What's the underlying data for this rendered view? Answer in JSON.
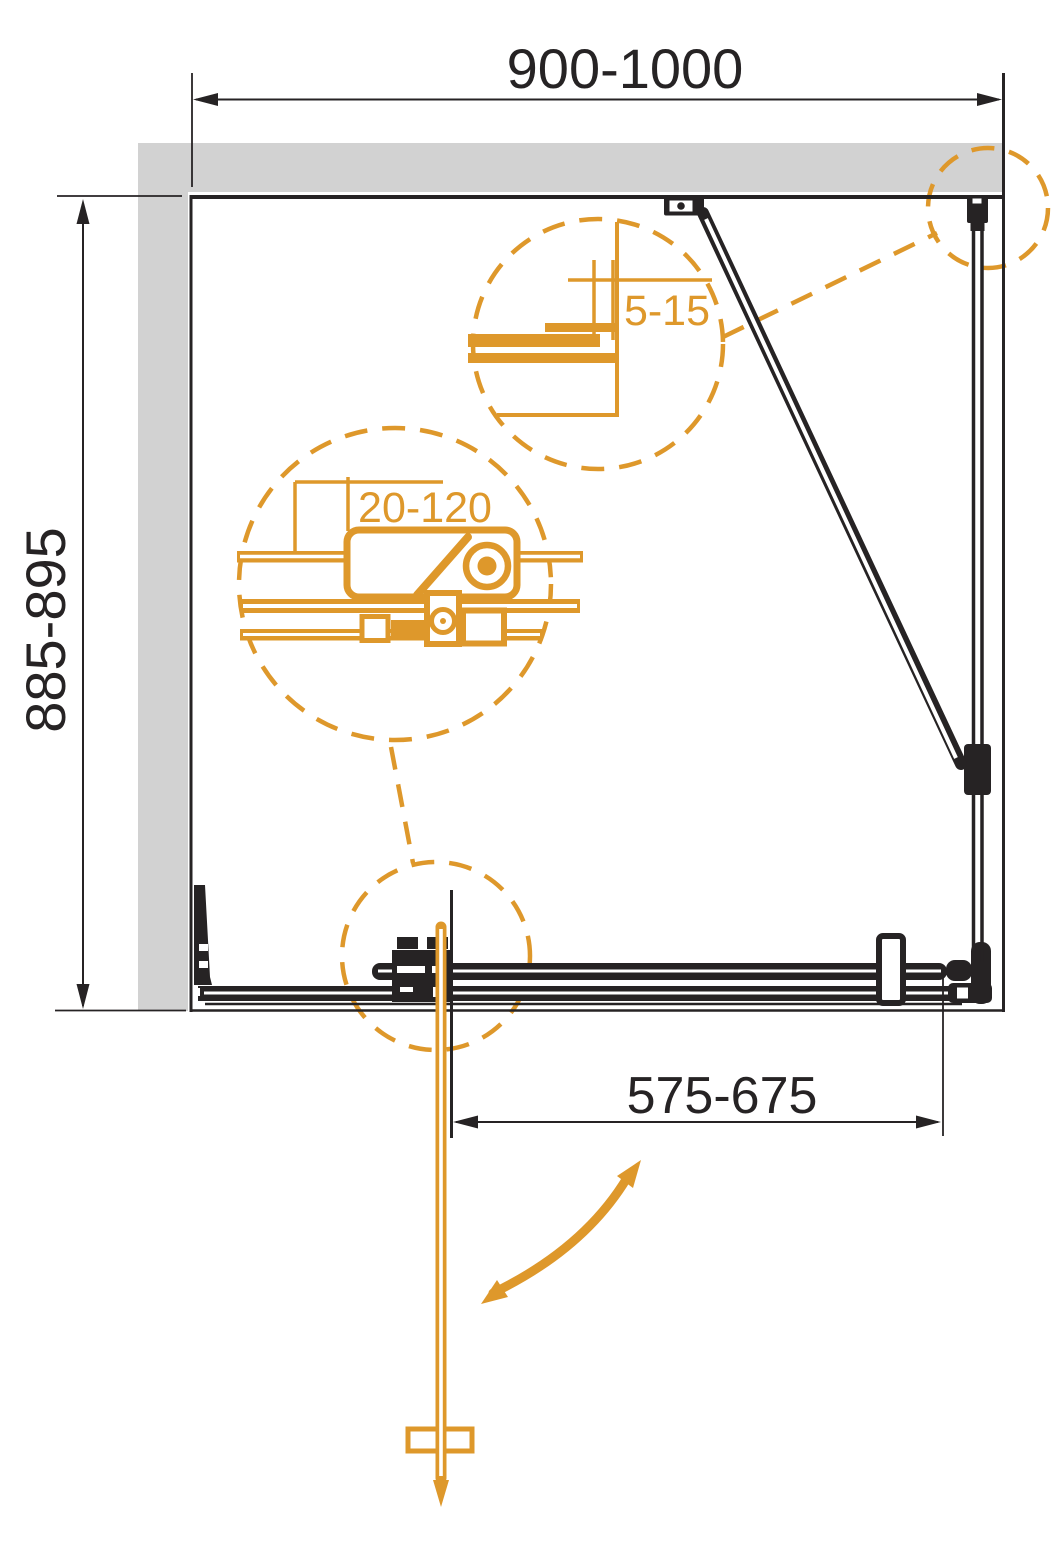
{
  "colors": {
    "line": "#262324",
    "accent": "#DE982B",
    "wall": "#D2D2D2",
    "bg": "#FFFFFF"
  },
  "dimensions": {
    "overall_width": "900-1000",
    "overall_depth": "885-895",
    "door_opening": "575-675",
    "wall_clearance": "5-15",
    "profile_adjustment": "20-120"
  }
}
